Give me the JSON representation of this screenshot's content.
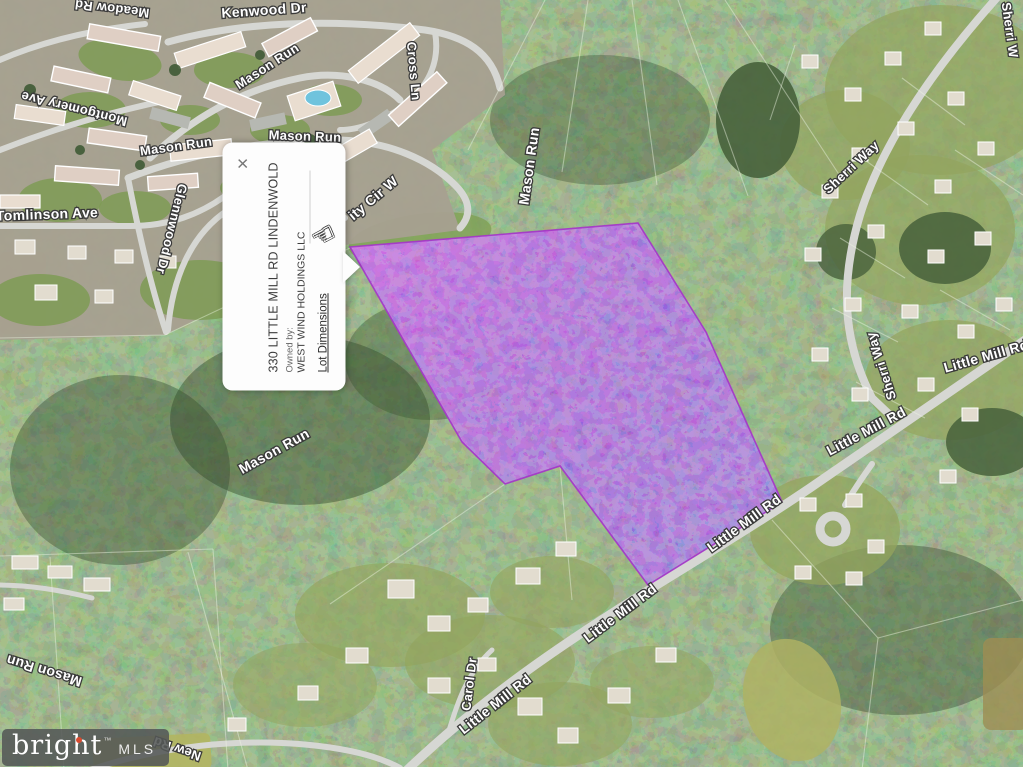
{
  "map": {
    "labels": [
      {
        "text": "Meadow Rd",
        "x": 112,
        "y": 9,
        "rot": 187,
        "size": 13
      },
      {
        "text": "Kenwood Dr",
        "x": 264,
        "y": 10,
        "rot": -4,
        "size": 14
      },
      {
        "text": "Mason Run",
        "x": 267,
        "y": 66,
        "rot": -33,
        "size": 13
      },
      {
        "text": "Montgomery Ave",
        "x": 74,
        "y": 109,
        "rot": 194,
        "size": 13
      },
      {
        "text": "Mason Run",
        "x": 176,
        "y": 146,
        "rot": -8,
        "size": 13
      },
      {
        "text": "Mason Run",
        "x": 305,
        "y": 136,
        "rot": 2,
        "size": 13
      },
      {
        "text": "Tomlinson Ave",
        "x": 47,
        "y": 214,
        "rot": -2,
        "size": 14
      },
      {
        "text": "Glennwood Dr",
        "x": 172,
        "y": 229,
        "rot": 104,
        "size": 13
      },
      {
        "text": "Cross Ln",
        "x": 414,
        "y": 71,
        "rot": 85,
        "size": 13
      },
      {
        "text": "ity Cir W",
        "x": 373,
        "y": 198,
        "rot": -40,
        "size": 14
      },
      {
        "text": "Mason Run",
        "x": 529,
        "y": 166,
        "rot": -82,
        "size": 14
      },
      {
        "text": "Sherri Way",
        "x": 851,
        "y": 167,
        "rot": -43,
        "size": 13
      },
      {
        "text": "Sherri W",
        "x": 1010,
        "y": 30,
        "rot": 82,
        "size": 13
      },
      {
        "text": "Sherri Way",
        "x": 881,
        "y": 366,
        "rot": -108,
        "size": 13
      },
      {
        "text": "Little Mill Rd",
        "x": 986,
        "y": 356,
        "rot": -16,
        "size": 14
      },
      {
        "text": "Little Mill Rd",
        "x": 866,
        "y": 431,
        "rot": -28,
        "size": 14
      },
      {
        "text": "Little Mill Rd",
        "x": 744,
        "y": 523,
        "rot": -36,
        "size": 14
      },
      {
        "text": "Little Mill Rd",
        "x": 620,
        "y": 613,
        "rot": -37,
        "size": 14
      },
      {
        "text": "Little Mill Rd",
        "x": 495,
        "y": 704,
        "rot": -38,
        "size": 14
      },
      {
        "text": "Carol Dr",
        "x": 469,
        "y": 684,
        "rot": -83,
        "size": 13
      },
      {
        "text": "Mason Run",
        "x": 274,
        "y": 451,
        "rot": -29,
        "size": 14
      },
      {
        "text": "Mason Run",
        "x": 44,
        "y": 671,
        "rot": 197,
        "size": 14
      },
      {
        "text": "New Rd",
        "x": 177,
        "y": 749,
        "rot": 199,
        "size": 13
      }
    ],
    "parcel": {
      "points": "350,247 638,223 706,332 782,502 648,585 560,466 505,484 462,442",
      "fill_base": "#6a3ab0",
      "stroke": "#a435c8"
    }
  },
  "popup": {
    "close_icon": "×",
    "title": "330 LITTLE MILL RD LINDENWOLD",
    "owned_by_label": "Owned by:",
    "owner": "WEST WIND HOLDINGS LLC",
    "lot_dimensions_label": "Lot Dimensions"
  },
  "icons": {
    "hand_cursor": "☜"
  },
  "logo": {
    "brand": "bright",
    "tm": "™",
    "suffix": "MLS"
  }
}
